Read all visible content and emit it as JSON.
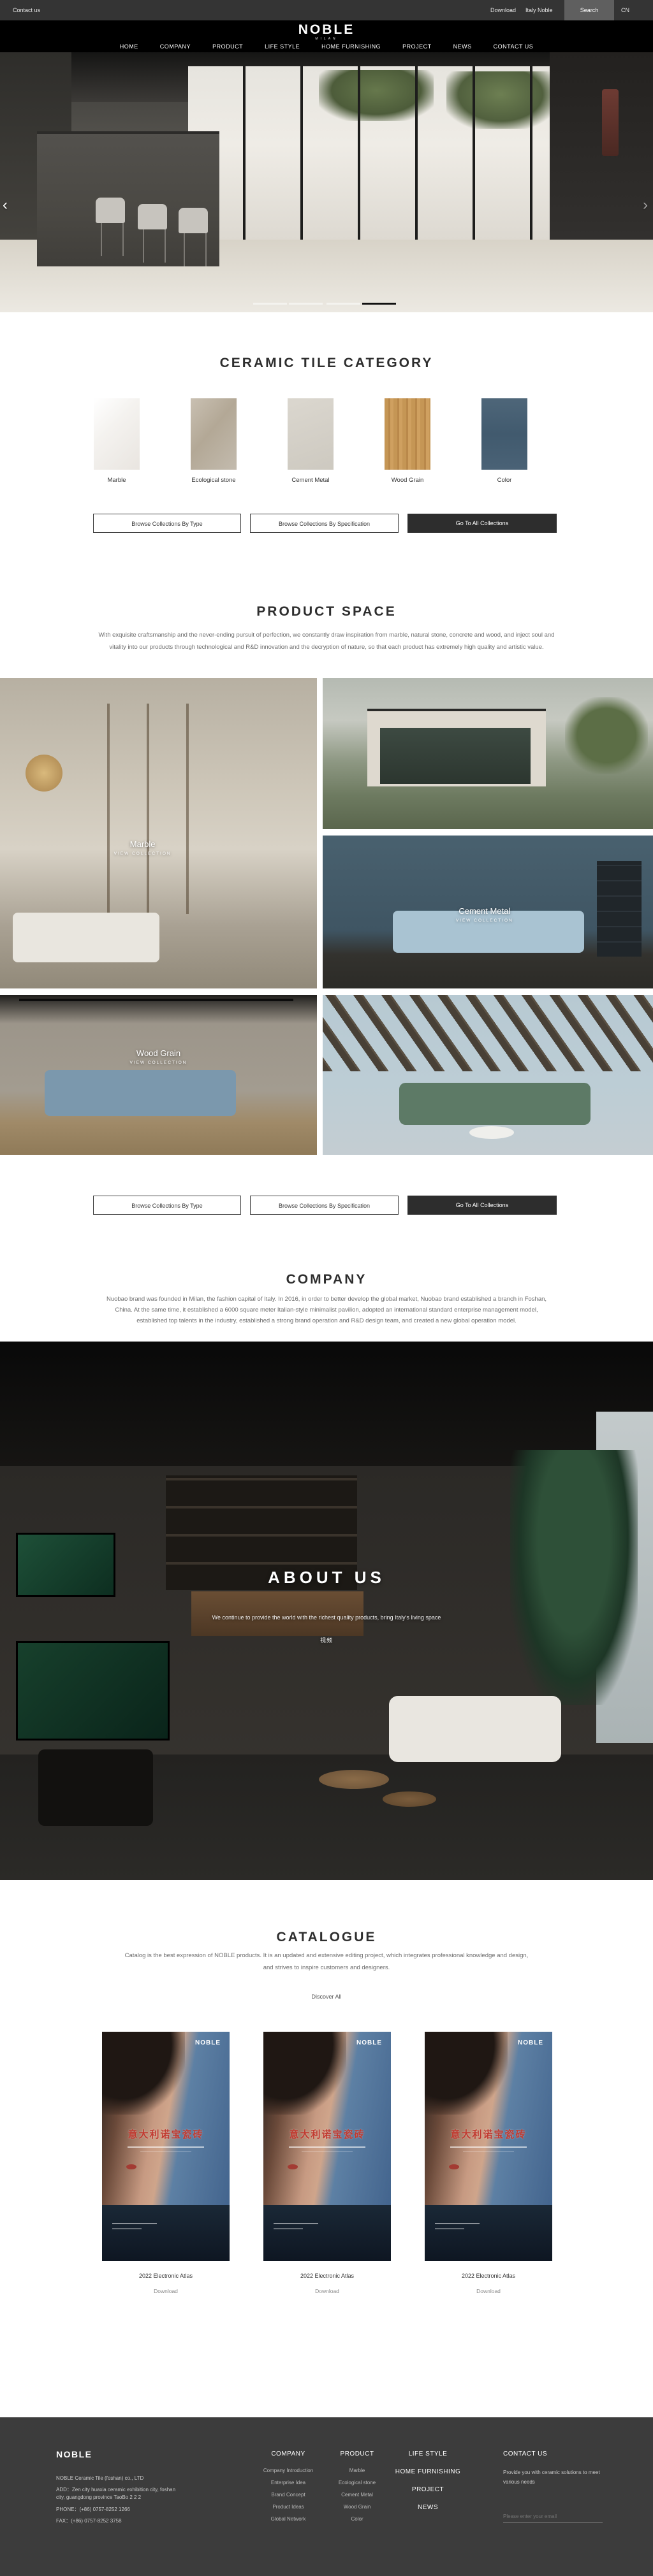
{
  "colors": {
    "topbar_bg": "#343434",
    "header_bg": "#000000",
    "footer_bg": "#3c3c3c",
    "dark_button_bg": "#2d2d2d",
    "pagination_active": "#111111",
    "cover_title_red": "#c13a30",
    "color_tile_blue": "#4a6276"
  },
  "topbar": {
    "contact_us": "Contact us",
    "download": "Download",
    "italy_noble": "Italy Noble",
    "search": "Search",
    "language": "CN"
  },
  "header": {
    "logo": "NOBLE",
    "logo_subtitle": "MILAN",
    "nav": [
      "HOME",
      "COMPANY",
      "PRODUCT",
      "LIFE STYLE",
      "HOME FURNISHING",
      "PROJECT",
      "NEWS",
      "CONTACT US"
    ]
  },
  "hero": {
    "prev": "‹",
    "next": "›"
  },
  "category": {
    "title": "CERAMIC TILE CATEGORY",
    "tiles": [
      {
        "label": "Marble"
      },
      {
        "label": "Ecological stone"
      },
      {
        "label": "Cement Metal"
      },
      {
        "label": "Wood Grain"
      },
      {
        "label": "Color"
      }
    ]
  },
  "collection_buttons": {
    "by_type": "Browse Collections By Type",
    "by_specification": "Browse Collections By Specification",
    "go_to_all": "Go To All Collections"
  },
  "product_space": {
    "title": "PRODUCT SPACE",
    "description": "With exquisite craftsmanship and the never-ending pursuit of perfection, we constantly draw inspiration from marble, natural stone, concrete and wood, and inject soul and vitality into our products through technological and R&D innovation and the decryption of nature, so that each product has extremely high quality and artistic value.",
    "items": [
      {
        "label": "Marble",
        "cta": "VIEW COLLECTION"
      },
      {
        "label": "Cement Metal",
        "cta": "VIEW COLLECTION"
      },
      {
        "label": "Wood Grain",
        "cta": "VIEW COLLECTION"
      }
    ]
  },
  "company": {
    "title": "COMPANY",
    "description": "Nuobao brand was founded in Milan, the fashion capital of Italy. In 2016, in order to better develop the global market, Nuobao brand established a branch in Foshan, China. At the same time, it established a 6000 square meter Italian-style minimalist pavilion, adopted an international standard enterprise management model, established top talents in the industry, established a strong brand operation and R&D design team, and created a new global operation model."
  },
  "about": {
    "title": "ABOUT US",
    "description": "We continue to provide the world with the richest quality products, bring Italy's living space",
    "video_label": "视频"
  },
  "catalogue": {
    "title": "CATALOGUE",
    "description": "Catalog is the best expression of NOBLE products. It is an updated and extensive editing project, which integrates professional knowledge and design, and strives to inspire customers and designers.",
    "discover_all": "Discover All",
    "cover_brand": "NOBLE",
    "cover_title": "意大利诺宝瓷砖",
    "items": [
      {
        "name": "2022 Electronic Atlas",
        "download": "Download"
      },
      {
        "name": "2022 Electronic Atlas",
        "download": "Download"
      },
      {
        "name": "2022 Electronic Atlas",
        "download": "Download"
      }
    ]
  },
  "footer": {
    "logo": "NOBLE",
    "company_name": "NOBLE Ceramic Tile (foshan) co., LTD",
    "address_line1": "ADD：Zen city huaxia ceramic exhibition city, foshan",
    "address_line2": "city, guangdong province TaoBo 2 2 2",
    "phone": "PHONE：(+86) 0757-8252 1266",
    "fax": "FAX：(+86) 0757-8252 3758",
    "columns": [
      {
        "title": "COMPANY",
        "items": [
          "Company Introduction",
          "Enterprise Idea",
          "Brand Concept",
          "Product Ideas",
          "Global Network"
        ]
      },
      {
        "title": "PRODUCT",
        "items": [
          "Marble",
          "Ecological stone",
          "Cement Metal",
          "Wood Grain",
          "Color"
        ]
      }
    ],
    "nav_links": [
      "LIFE STYLE",
      "HOME FURNISHING",
      "PROJECT",
      "NEWS"
    ],
    "contact": {
      "title": "CONTACT US",
      "text": "Provide you with ceramic solutions to meet various needs",
      "email_placeholder": "Please enter your email"
    }
  }
}
